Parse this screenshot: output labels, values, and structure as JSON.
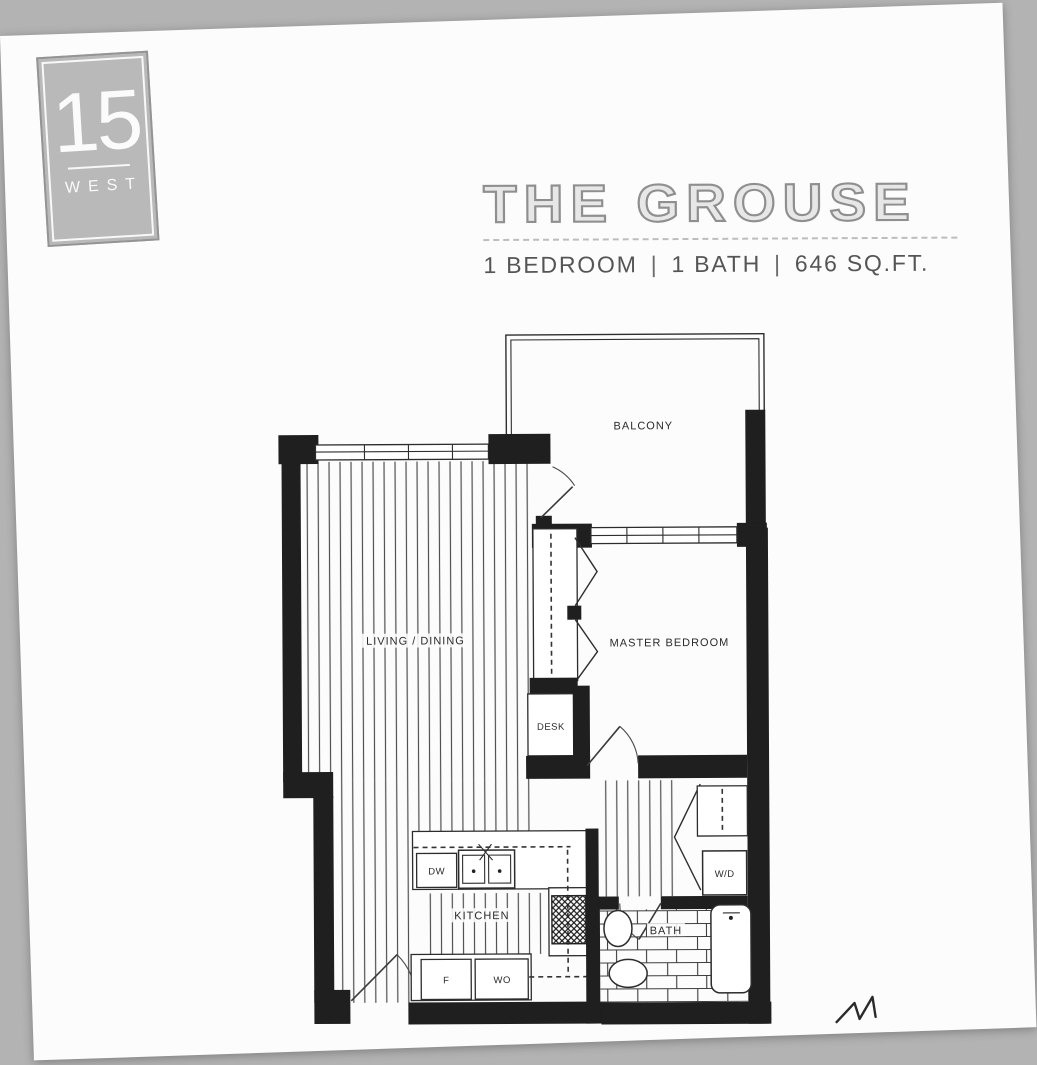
{
  "colors": {
    "scan_background": "#b3b3b3",
    "page": "#fcfcfc",
    "ink": "#1f1f1f",
    "title_fill": "#e7e7e7",
    "title_stroke": "#8f8f8f",
    "logo_background": "#b9b9b9"
  },
  "logo": {
    "number": "15",
    "name": "WEST"
  },
  "header": {
    "title": "THE GROUSE",
    "separator": "|",
    "specs": [
      "1 BEDROOM",
      "1 BATH",
      "646 SQ.FT."
    ]
  },
  "floorplan": {
    "labels": {
      "balcony": "BALCONY",
      "living_dining": "LIVING / DINING",
      "master_bedroom": "MASTER BEDROOM",
      "desk": "DESK",
      "kitchen": "KITCHEN",
      "bath": "BATH",
      "dishwasher": "DW",
      "fridge": "F",
      "wall_oven": "WO",
      "washer_dryer": "W/D"
    }
  },
  "icons": {
    "pen_mark": "handwritten-initial-squiggle"
  }
}
